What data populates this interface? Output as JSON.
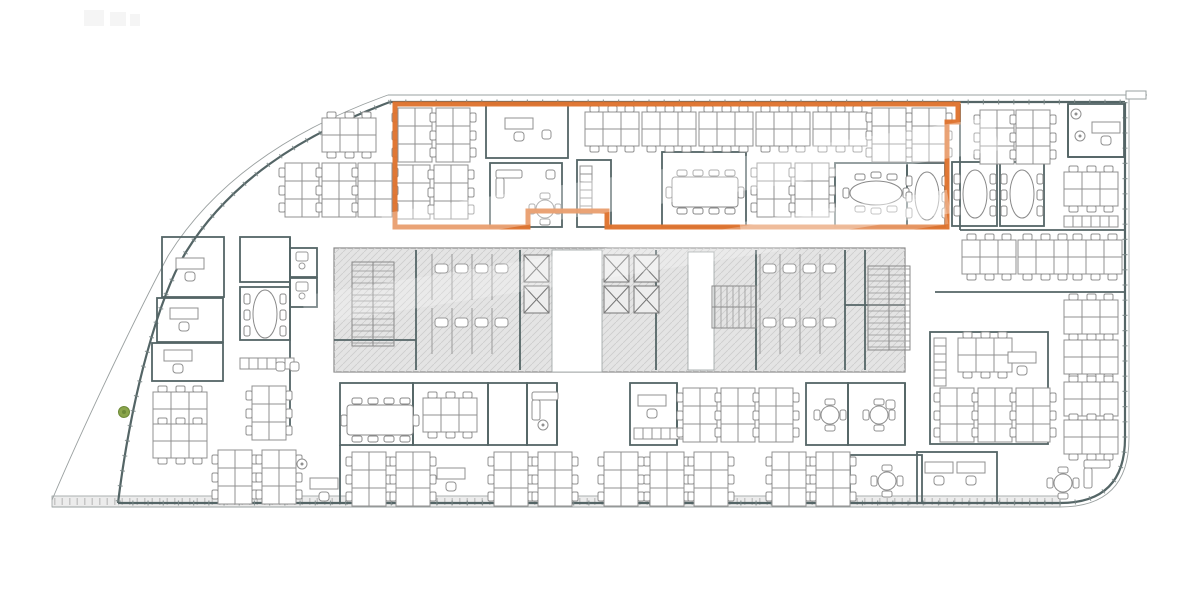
{
  "plan": {
    "canvas": {
      "w": 1200,
      "h": 600
    },
    "colors": {
      "highlight": "#df7430",
      "wall": "#546566",
      "wallThin": "#9aa0a0",
      "tick": "#7c8888",
      "furniture": "#909090",
      "coreFill": "#e4e4e4",
      "coreHatch": "#cccccc",
      "coreStroke": "#8a8a8a",
      "band": "#ececec",
      "bandTick": "#c6c6c6",
      "plant": "#8aa54b",
      "white": "#ffffff"
    },
    "outline": {
      "inner": [
        "M390,102 H1125",
        "M1125,102 V438 Q1125,503 1060,503 H118",
        "M390,102 C298,136 228,184 186,252 C160,295 132,390 118,503"
      ],
      "outer": [
        "M388,95 H1147",
        "M1129,97 V438 Q1129,507 1060,507 H52",
        "M388,95 C290,130 214,182 168,256 C138,312 86,420 52,500"
      ],
      "tab": [
        1126,
        91,
        20,
        8
      ],
      "band": [
        52,
        496,
        1008,
        11
      ]
    },
    "core": {
      "rect": [
        334,
        248,
        571,
        124
      ],
      "strips": [
        [
          552,
          250,
          50,
          122
        ],
        [
          688,
          252,
          26,
          118
        ]
      ]
    },
    "highlight": {
      "points": "395,104 958,104 958,122 947,122 947,227 607,227 607,211 528,211 528,227 395,227",
      "width": 5
    },
    "rooms": [
      [
        486,
        104,
        82,
        54
      ],
      [
        490,
        163,
        72,
        64
      ],
      [
        577,
        160,
        34,
        67
      ],
      [
        662,
        152,
        84,
        75
      ],
      [
        835,
        163,
        72,
        64
      ],
      [
        907,
        163,
        38,
        64
      ],
      [
        1068,
        104,
        56,
        53
      ],
      [
        952,
        162,
        45,
        64
      ],
      [
        1000,
        162,
        44,
        64
      ],
      [
        930,
        332,
        118,
        112
      ],
      [
        917,
        452,
        80,
        51
      ],
      [
        850,
        455,
        72,
        48
      ],
      [
        162,
        237,
        62,
        60
      ],
      [
        157,
        298,
        66,
        44
      ],
      [
        152,
        343,
        71,
        38
      ],
      [
        240,
        237,
        50,
        45
      ],
      [
        240,
        287,
        50,
        53
      ],
      [
        290,
        248,
        27,
        29
      ],
      [
        290,
        278,
        27,
        29
      ],
      [
        340,
        383,
        73,
        62
      ],
      [
        413,
        383,
        75,
        62
      ],
      [
        488,
        383,
        39,
        62
      ],
      [
        527,
        383,
        30,
        62
      ],
      [
        630,
        383,
        47,
        62
      ],
      [
        806,
        383,
        42,
        62
      ],
      [
        848,
        383,
        57,
        62
      ]
    ],
    "walls": [
      [
        960,
        104,
        960,
        230
      ],
      [
        1068,
        104,
        1068,
        157
      ],
      [
        1068,
        157,
        1125,
        157
      ],
      [
        960,
        230,
        1125,
        230
      ],
      [
        935,
        292,
        1125,
        292
      ],
      [
        290,
        237,
        290,
        430
      ],
      [
        340,
        445,
        340,
        503
      ],
      [
        557,
        383,
        557,
        445
      ],
      [
        677,
        383,
        677,
        445
      ],
      [
        905,
        383,
        905,
        445
      ],
      [
        416,
        250,
        416,
        370
      ],
      [
        520,
        250,
        520,
        370
      ],
      [
        656,
        250,
        656,
        370
      ],
      [
        756,
        250,
        756,
        370
      ],
      [
        845,
        250,
        845,
        370
      ],
      [
        865,
        250,
        865,
        370
      ],
      [
        334,
        340,
        416,
        340
      ],
      [
        845,
        305,
        905,
        305
      ]
    ],
    "furniture": [
      [
        "deskV",
        398,
        108
      ],
      [
        "deskV",
        436,
        108
      ],
      [
        "deskH",
        585,
        112
      ],
      [
        "deskH",
        642,
        112
      ],
      [
        "deskH",
        699,
        112
      ],
      [
        "deskH",
        756,
        112
      ],
      [
        "deskH",
        813,
        112
      ],
      [
        "deskV",
        872,
        108
      ],
      [
        "deskV",
        912,
        108
      ],
      [
        "office",
        505,
        118
      ],
      [
        "chair",
        542,
        130
      ],
      [
        "deskV",
        396,
        165
      ],
      [
        "deskV",
        434,
        165
      ],
      [
        "deskV",
        757,
        163
      ],
      [
        "deskV",
        795,
        163
      ],
      [
        "meet10",
        670,
        168
      ],
      [
        "oval8",
        845,
        172
      ],
      [
        "ovalV",
        910,
        168
      ],
      [
        "sofa",
        496,
        170
      ],
      [
        "round4",
        530,
        194
      ],
      [
        "chair",
        546,
        170
      ],
      [
        "cabV",
        580,
        166
      ],
      [
        "deskH",
        322,
        118
      ],
      [
        "deskV",
        285,
        163
      ],
      [
        "deskV",
        322,
        163
      ],
      [
        "deskV",
        358,
        163
      ],
      [
        "deskV",
        980,
        110
      ],
      [
        "deskV",
        1016,
        110
      ],
      [
        "office",
        1092,
        122
      ],
      [
        "plantGray",
        1076,
        114
      ],
      [
        "plantGray",
        1080,
        136
      ],
      [
        "ovalV",
        958,
        166
      ],
      [
        "ovalV",
        1005,
        166
      ],
      [
        "deskH",
        1064,
        172
      ],
      [
        "cabH",
        1064,
        216
      ],
      [
        "deskH",
        962,
        240
      ],
      [
        "deskH",
        1018,
        240
      ],
      [
        "deskH",
        1068,
        240
      ],
      [
        "cabV",
        934,
        338
      ],
      [
        "deskH",
        958,
        338
      ],
      [
        "office",
        1008,
        352
      ],
      [
        "deskV",
        940,
        388
      ],
      [
        "deskV",
        978,
        388
      ],
      [
        "deskV",
        1016,
        388
      ],
      [
        "deskH",
        1064,
        300
      ],
      [
        "deskH",
        1064,
        340
      ],
      [
        "deskH",
        1064,
        382
      ],
      [
        "deskH",
        1064,
        420
      ],
      [
        "office",
        925,
        462
      ],
      [
        "office",
        957,
        462
      ],
      [
        "round4",
        1048,
        468
      ],
      [
        "sofa",
        1084,
        460
      ],
      [
        "office",
        176,
        258
      ],
      [
        "office",
        170,
        308
      ],
      [
        "office",
        164,
        350
      ],
      [
        "ovalV",
        248,
        286
      ],
      [
        "cabH",
        240,
        358
      ],
      [
        "chair",
        276,
        362
      ],
      [
        "chair",
        290,
        362
      ],
      [
        "deskV",
        252,
        386
      ],
      [
        "deskH",
        153,
        392
      ],
      [
        "deskH",
        153,
        424
      ],
      [
        "plantGreen",
        124,
        412
      ],
      [
        "deskV",
        218,
        450
      ],
      [
        "deskV",
        262,
        450
      ],
      [
        "plantGray",
        302,
        464
      ],
      [
        "office",
        310,
        478
      ],
      [
        "meet10",
        345,
        396
      ],
      [
        "deskH",
        423,
        398
      ],
      [
        "sofa",
        532,
        392
      ],
      [
        "plantGray",
        543,
        425
      ],
      [
        "office",
        638,
        395
      ],
      [
        "cabH",
        634,
        428
      ],
      [
        "deskV",
        683,
        388
      ],
      [
        "deskV",
        721,
        388
      ],
      [
        "deskV",
        759,
        388
      ],
      [
        "round4",
        815,
        400
      ],
      [
        "round4",
        864,
        400
      ],
      [
        "chair",
        886,
        400
      ],
      [
        "deskV",
        352,
        452
      ],
      [
        "deskV",
        396,
        452
      ],
      [
        "office",
        437,
        468
      ],
      [
        "deskV",
        494,
        452
      ],
      [
        "deskV",
        538,
        452
      ],
      [
        "deskV",
        604,
        452
      ],
      [
        "deskV",
        650,
        452
      ],
      [
        "deskV",
        694,
        452
      ],
      [
        "deskV",
        772,
        452
      ],
      [
        "deskV",
        816,
        452
      ],
      [
        "round4",
        872,
        466
      ],
      [
        "elev",
        524,
        255
      ],
      [
        "elev",
        524,
        286
      ],
      [
        "elev",
        604,
        255
      ],
      [
        "elev",
        604,
        286
      ],
      [
        "elev",
        634,
        255
      ],
      [
        "elev",
        634,
        286
      ],
      [
        "stairV",
        352,
        262
      ],
      [
        "stairV",
        868,
        266
      ],
      [
        "stairH",
        712,
        286
      ],
      [
        "stall",
        432,
        254
      ],
      [
        "stall",
        452,
        254
      ],
      [
        "stall",
        472,
        254
      ],
      [
        "stall",
        492,
        254
      ],
      [
        "stall",
        432,
        308
      ],
      [
        "stall",
        452,
        308
      ],
      [
        "stall",
        472,
        308
      ],
      [
        "stall",
        492,
        308
      ],
      [
        "stall",
        760,
        254
      ],
      [
        "stall",
        780,
        254
      ],
      [
        "stall",
        800,
        254
      ],
      [
        "stall",
        820,
        254
      ],
      [
        "stall",
        760,
        308
      ],
      [
        "stall",
        780,
        308
      ],
      [
        "stall",
        800,
        308
      ],
      [
        "stall",
        820,
        308
      ],
      [
        "wc",
        296,
        252
      ],
      [
        "wc",
        296,
        282
      ]
    ],
    "watermark": {
      "angle": -9,
      "bands": [
        [
          380,
          165,
          620,
          34,
          0.32
        ],
        [
          300,
          245,
          650,
          30,
          0.24
        ],
        [
          740,
          206,
          210,
          24,
          0.35
        ]
      ]
    },
    "smudges": [
      [
        84,
        10,
        20,
        16
      ],
      [
        110,
        12,
        16,
        14
      ],
      [
        130,
        14,
        10,
        12
      ]
    ]
  }
}
